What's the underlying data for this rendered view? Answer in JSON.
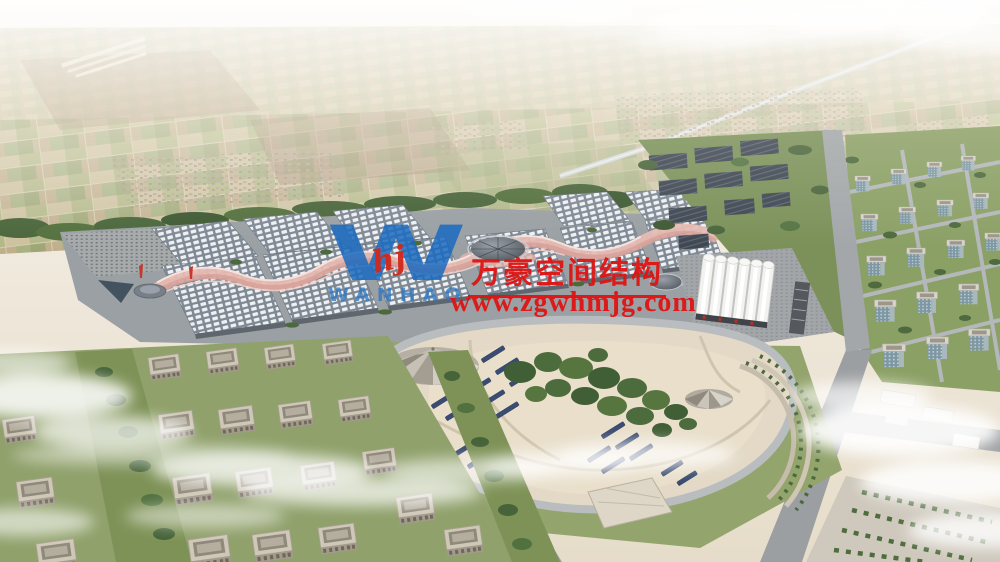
{
  "watermark": {
    "logo_letter": "W",
    "logo_mark": "hj",
    "logo_text": "WANHAO",
    "company_name_cn": "万豪空间结构",
    "website": "www.zgwhmjg.com",
    "accent_red": "#e01312",
    "logo_blue": "#1a6ac0"
  },
  "scene": {
    "palette": {
      "sky_haze": "#f4f0e9",
      "farmland": "#cdc4a5",
      "trees": "#4b663c",
      "hall_roof": "#7f8994",
      "canopy_pink": "#e3b0a8",
      "park_ground": "#e3d9c6",
      "solar_panel": "#3a4c72",
      "road": "#9c9fa2",
      "residential_roof": "#cfc8b8",
      "cloud": "#ffffff"
    }
  }
}
